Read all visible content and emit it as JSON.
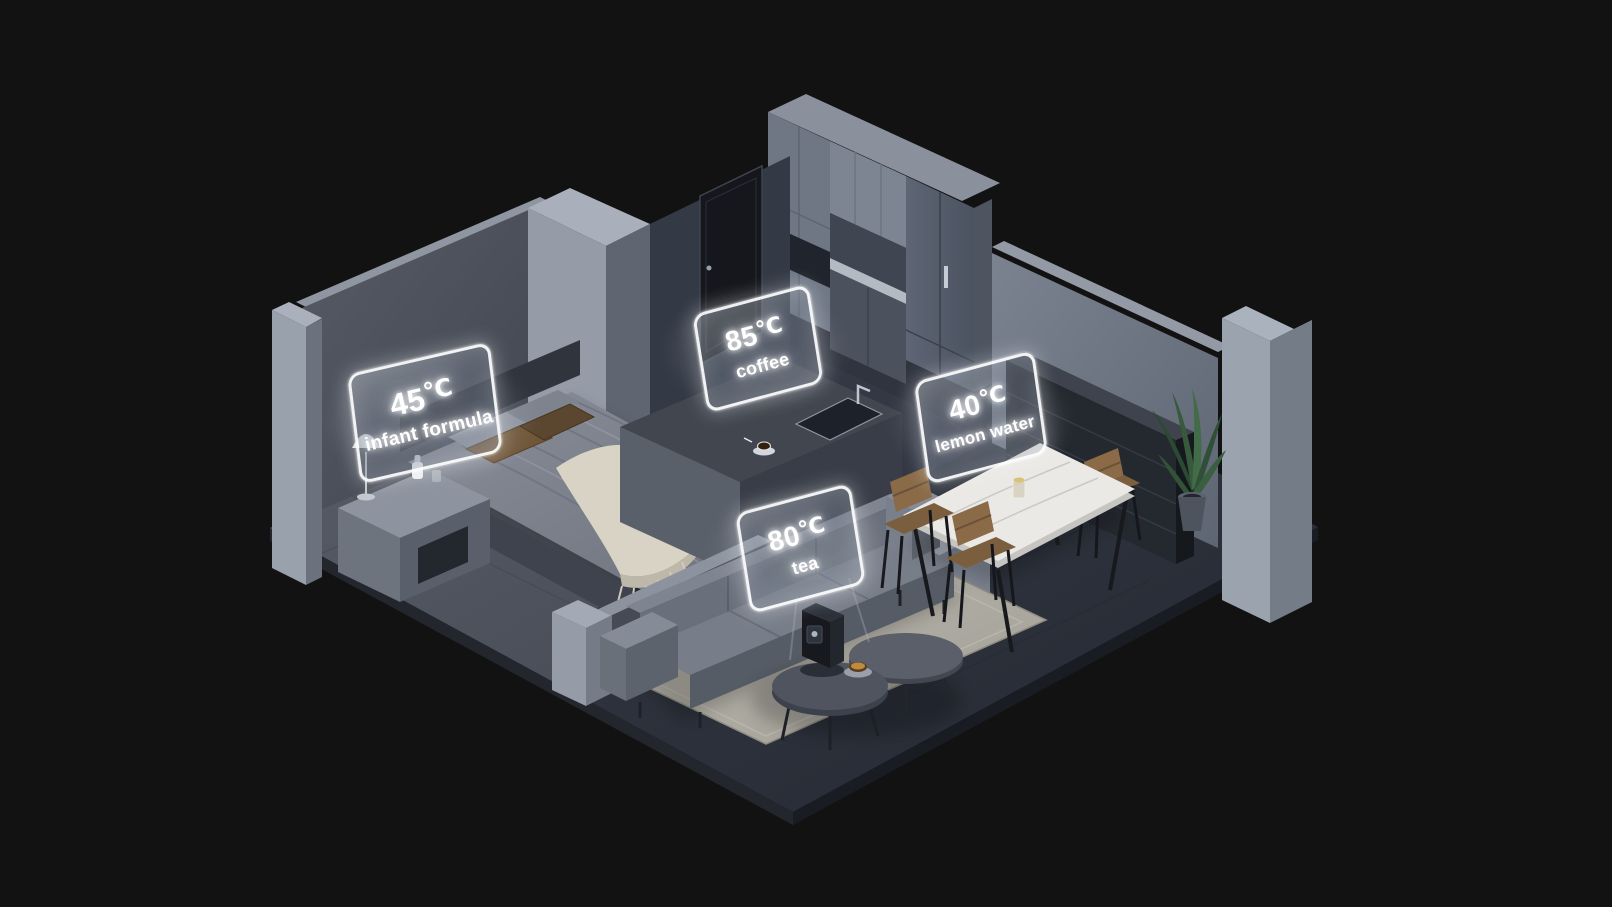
{
  "scene": {
    "type": "isometric-apartment-render",
    "background_color": "#121213",
    "label_glow_color": "#ffffff"
  },
  "labels": [
    {
      "temp": "45",
      "unit": "℃",
      "drink": "infant formula"
    },
    {
      "temp": "85",
      "unit": "℃",
      "drink": "coffee"
    },
    {
      "temp": "40",
      "unit": "℃",
      "drink": "lemon water"
    },
    {
      "temp": "80",
      "unit": "℃",
      "drink": "tea"
    }
  ],
  "palette": {
    "wall_light": "#9aa1ad",
    "wall_mid": "#6d7582",
    "wall_dark": "#474c57",
    "floor_bedroom": "#51565f",
    "floor_living": "#2e323c",
    "rug": "#b2b0a6",
    "wood_chair": "#8a6a47",
    "plant_green": "#375a3c",
    "marble_table": "#ebe9e5",
    "blanket_cream": "#d8d3c4",
    "panel_border": "#ffffff"
  }
}
